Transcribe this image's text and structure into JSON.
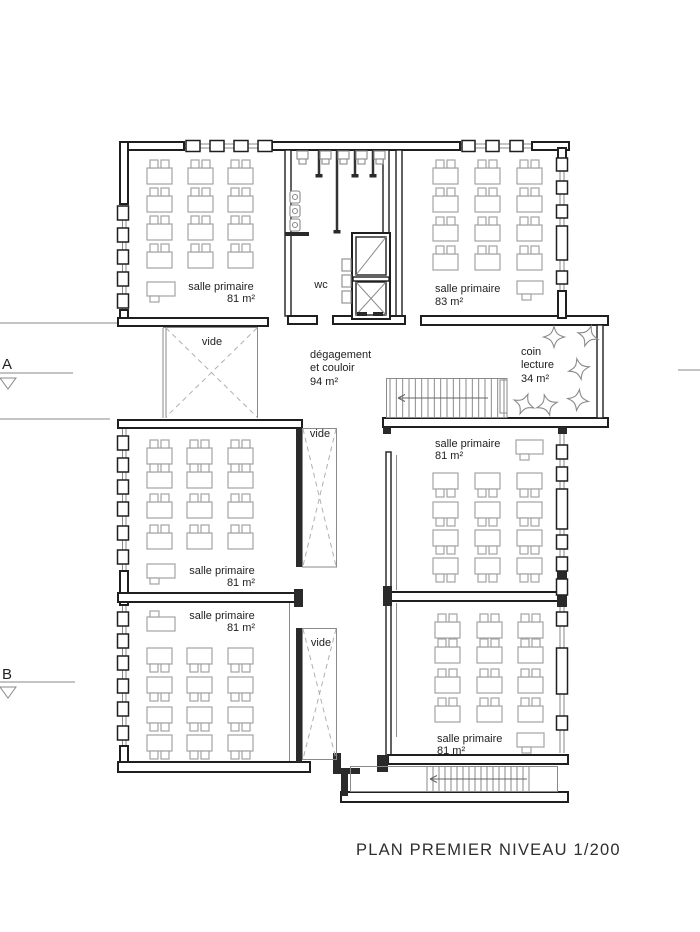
{
  "title": "PLAN PREMIER NIVEAU 1/200",
  "markers": [
    {
      "label": "A"
    },
    {
      "label": "B"
    }
  ],
  "rooms": [
    {
      "id": "salle-primaire-top-left",
      "name": "salle primaire",
      "area": "81 m²"
    },
    {
      "id": "wc",
      "name": "wc"
    },
    {
      "id": "salle-primaire-top-right",
      "name": "salle primaire",
      "area": "83 m²"
    },
    {
      "id": "degagement-couloir",
      "name_line1": "dégagement",
      "name_line2": "et couloir",
      "area": "94 m²"
    },
    {
      "id": "coin-lecture",
      "name_line1": "coin",
      "name_line2": "lecture",
      "area": "34 m²"
    },
    {
      "id": "salle-primaire-mid-left",
      "name": "salle primaire",
      "area": "81 m²"
    },
    {
      "id": "salle-primaire-mid-right",
      "name": "salle primaire",
      "area": "81 m²"
    },
    {
      "id": "salle-primaire-bottom-left",
      "name": "salle primaire",
      "area": "81 m²"
    },
    {
      "id": "salle-primaire-bottom-right",
      "name": "salle primaire",
      "area": "81 m²"
    },
    {
      "id": "vide-upper",
      "name": "vide"
    },
    {
      "id": "vide-mid",
      "name": "vide"
    },
    {
      "id": "vide-lower",
      "name": "vide"
    }
  ],
  "colors": {
    "wall": "#1f1f1f",
    "furniture": "#a3a3a3",
    "text": "#222222"
  }
}
